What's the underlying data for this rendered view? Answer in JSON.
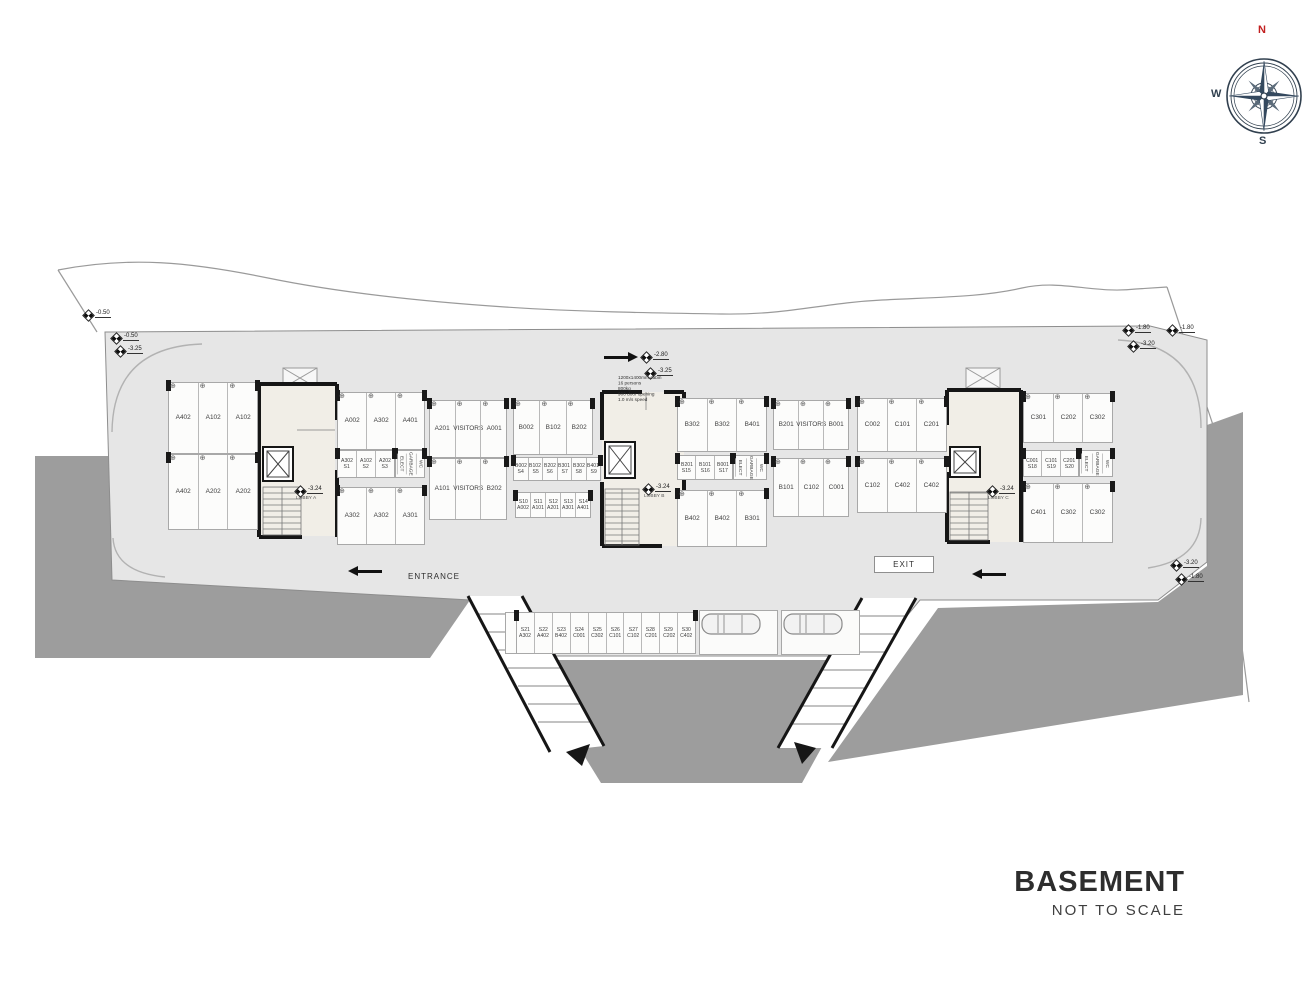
{
  "title": {
    "main": "BASEMENT",
    "subtitle": "NOT TO SCALE"
  },
  "compass": {
    "north": "N",
    "west": "W",
    "south": "S"
  },
  "labels": {
    "entrance": "ENTRANCE",
    "exit": "EXIT"
  },
  "markers": [
    "-0.50",
    "-0.50",
    "-3.25",
    "-1.80",
    "-1.80",
    "-3.20",
    "-2.80",
    "-3.25",
    "-3.20",
    "-1.80"
  ],
  "cores": {
    "a": {
      "level": "-3.24",
      "name": "LOBBY A"
    },
    "b": {
      "level": "-3.24",
      "name": "LOBBY B"
    },
    "c": {
      "level": "-3.24",
      "name": "LOBBY C"
    }
  },
  "elevator_note": {
    "lines": [
      "1200x1400mm cabin",
      "16 persons",
      "800kg",
      "900 door opening",
      "1.0 m/s speed"
    ]
  },
  "colors": {
    "earth": "#9d9d9d",
    "slab": "#e6e6e6",
    "lobby": "#f1eee7",
    "wall": "#161616",
    "north_red": "#c21f1f"
  },
  "blocks": {
    "a_left_r1": [
      "A402",
      "A102",
      "A102"
    ],
    "a_left_r2": [
      "A402",
      "A202",
      "A202"
    ],
    "a_right_r1": [
      "A002",
      "A302",
      "A401"
    ],
    "a_right_st": [
      {
        "a": "A302",
        "b": "S1"
      },
      {
        "a": "A102",
        "b": "S2"
      },
      {
        "a": "A202",
        "b": "S3"
      }
    ],
    "a_rooms": [
      "ELECT",
      "GARBAGE",
      "WC"
    ],
    "a_right_r2": [
      "A302",
      "A302",
      "A301"
    ],
    "av_r1": [
      "A201",
      "VISITORS",
      "A001"
    ],
    "av_r2": [
      "A101",
      "VISITORS",
      "B202"
    ],
    "b_left_r1": [
      "B002",
      "B102",
      "B202"
    ],
    "b_st_top": [
      {
        "a": "B002",
        "b": "S4"
      },
      {
        "a": "B102",
        "b": "S5"
      },
      {
        "a": "B202",
        "b": "S6"
      },
      {
        "a": "B301",
        "b": "S7"
      },
      {
        "a": "B302",
        "b": "S8"
      },
      {
        "a": "B401",
        "b": "S9"
      }
    ],
    "b_st_bottom": [
      {
        "a": "S10",
        "b": "A002"
      },
      {
        "a": "S11",
        "b": "A101"
      },
      {
        "a": "S12",
        "b": "A201"
      },
      {
        "a": "S13",
        "b": "A301"
      },
      {
        "a": "S14",
        "b": "A401"
      }
    ],
    "b_right_r1": [
      "B302",
      "B302",
      "B401"
    ],
    "b_right_st": [
      {
        "a": "B201",
        "b": "S15"
      },
      {
        "a": "B101",
        "b": "S16"
      },
      {
        "a": "B001",
        "b": "S17"
      }
    ],
    "b_rooms": [
      "ELECT",
      "GARBAGE",
      "WC"
    ],
    "b_right_r2": [
      "B402",
      "B402",
      "B301"
    ],
    "bv_r1": [
      "B201",
      "VISITORS",
      "B001"
    ],
    "bv_r2": [
      "B101",
      "C102",
      "C001"
    ],
    "c_left_r1": [
      "C002",
      "C101",
      "C201"
    ],
    "c_left_r2": [
      "C102",
      "C402",
      "C402"
    ],
    "c_right_r1": [
      "C301",
      "C202",
      "C302"
    ],
    "c_right_st": [
      {
        "a": "C001",
        "b": "S18"
      },
      {
        "a": "C101",
        "b": "S19"
      },
      {
        "a": "C201",
        "b": "S20"
      }
    ],
    "c_rooms": [
      "ELECT",
      "GARBAGE",
      "WC"
    ],
    "c_right_r2": [
      "C401",
      "C302",
      "C302"
    ],
    "strip": [
      {
        "a": "S21",
        "b": "A302"
      },
      {
        "a": "S22",
        "b": "A402"
      },
      {
        "a": "S23",
        "b": "B402"
      },
      {
        "a": "S24",
        "b": "C001"
      },
      {
        "a": "S25",
        "b": "C302"
      },
      {
        "a": "S26",
        "b": "C101"
      },
      {
        "a": "S27",
        "b": "C102"
      },
      {
        "a": "S28",
        "b": "C201"
      },
      {
        "a": "S29",
        "b": "C202"
      },
      {
        "a": "S30",
        "b": "C402"
      }
    ]
  }
}
